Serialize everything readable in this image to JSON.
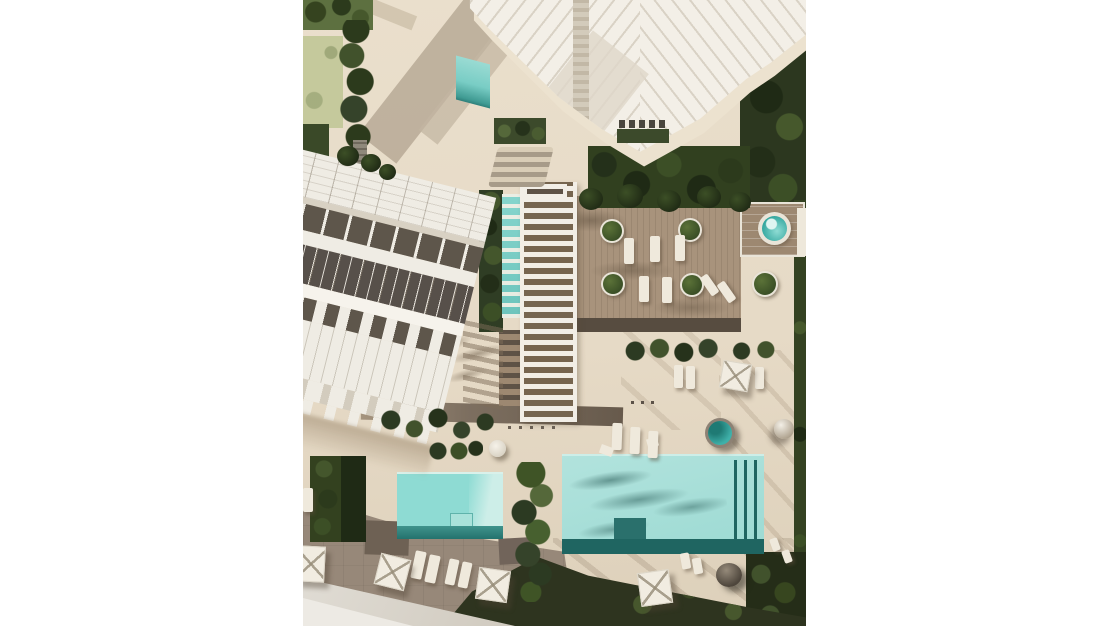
{
  "meta": {
    "domain": "natural-image",
    "subject": "top-down aerial 3D architectural rendering of a residential resort complex with pools, wooden deck, pergola walkway, townhouse row and high-rise tower",
    "no_visible_text": true
  },
  "palette": {
    "sand": "#eadfcc",
    "sand_shadow": "#c9bba5",
    "cream": "#ece2cf",
    "arch_white": "#f3efe7",
    "arch_line": "#d9d2c5",
    "dark_band": "#5e564b",
    "deck": "#a8937c",
    "deck_dark": "#574c40",
    "walkway_white": "#f2eee6",
    "pool_light": "#9cdad3",
    "pool_mid": "#8edbd3",
    "pool_teal": "#6cc4bc",
    "pool_dark": "#1f6561",
    "jacuzzi": "#2fa49c",
    "forest": "#2c371f",
    "hedge": "#2f3d24",
    "grass": "#5d7040",
    "lawn": "#c5c99c",
    "taupe": "#978879",
    "road": "#e0dcd4",
    "olive": "#2e341f",
    "path": "#7d6f60",
    "umbrella": "#f1ece1",
    "lounger": "#efe9dc",
    "planter_green": "#3a4f26"
  },
  "scene": {
    "objects": [
      "high-rise-tower",
      "tower-apron",
      "tower-rooftop-lap-pool",
      "townhouse-row",
      "pergola-walkway",
      "walkway-lap-pool",
      "wood-deck",
      "round-planters",
      "jacuzzi-plunge-pool-1",
      "jacuzzi-plunge-pool-2",
      "small-pool",
      "main-pool",
      "palm-cluster",
      "hedges",
      "forest-edges",
      "lawns",
      "paths",
      "taupe-patio",
      "gray-road",
      "sun-loungers",
      "parasols",
      "daybed",
      "side-table",
      "bench",
      "ball-sculpture"
    ],
    "counts": {
      "pools": 4,
      "plunge_pools": 2,
      "round_planters": 5,
      "parasols": 5,
      "sun_loungers_and_chairs": 22,
      "daybeds": 1,
      "benches": 1
    }
  }
}
